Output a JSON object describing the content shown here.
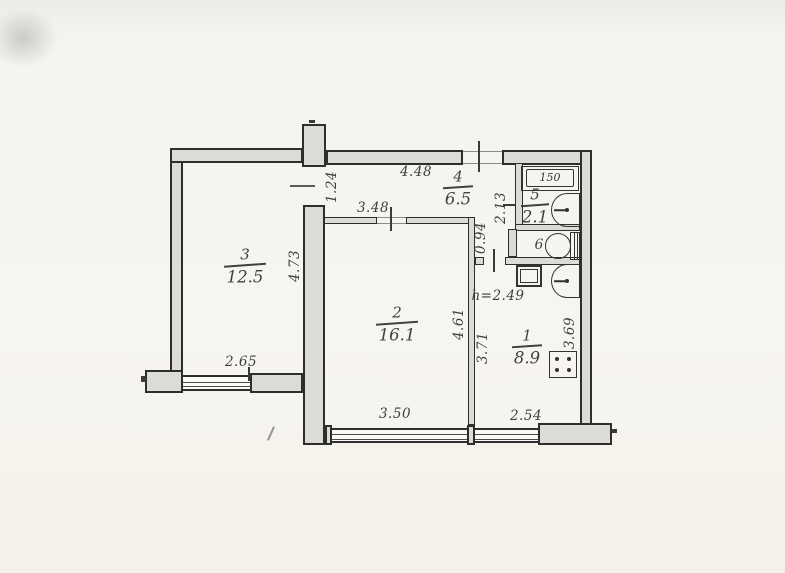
{
  "plan": {
    "type": "apartment-floor-plan",
    "rooms": {
      "r1": {
        "number": "1",
        "area": "8.9"
      },
      "r2": {
        "number": "2",
        "area": "16.1"
      },
      "r3": {
        "number": "3",
        "area": "12.5"
      },
      "r4": {
        "number": "4",
        "area": "6.5"
      },
      "r5": {
        "number": "5",
        "area": "2.1"
      },
      "r6": {
        "number": "6"
      }
    },
    "dims": {
      "corridor_top": "4.48",
      "room3_door": "1.24",
      "room2_top": "3.48",
      "room3_side": "4.73",
      "room3_window": "2.65",
      "room2_side": "4.61",
      "passage": "0.94",
      "bath_side": "2.13",
      "tub": "150",
      "kitchen_left": "3.71",
      "kitchen_right": "3.69",
      "room2_window": "3.50",
      "kitchen_window": "2.54",
      "ceiling_height": "h=2.49"
    },
    "fixtures": {
      "bathtub": "bathtub",
      "bath_sink": "washbasin",
      "toilet": "toilet",
      "kitchen_sink": "kitchen-sink",
      "stove": "stove",
      "vent": "vent-shaft"
    },
    "colors": {
      "paper": "#f6f4ef",
      "wall_fill": "#dcdbd6",
      "wall_line": "#2e2e2e",
      "ink": "#414141"
    }
  }
}
